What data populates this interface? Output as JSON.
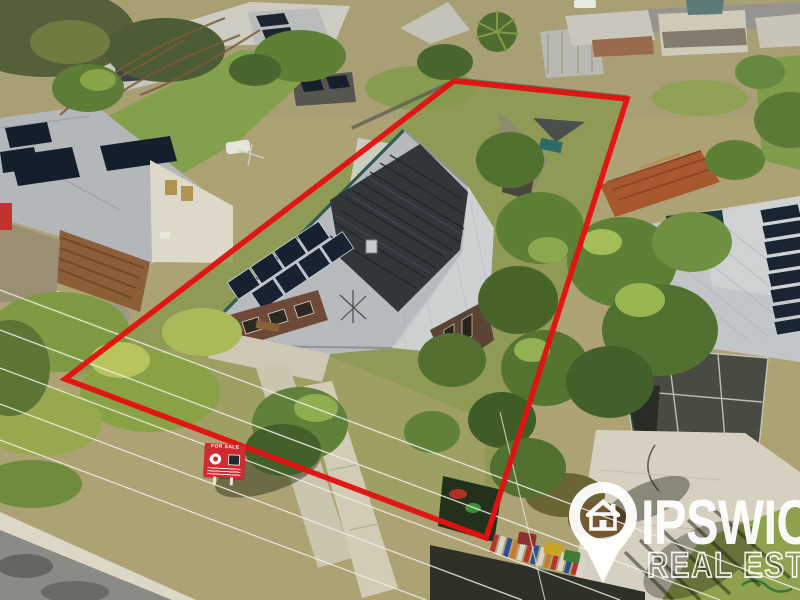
{
  "image_type": "aerial-drone-real-estate-photo",
  "watermark": {
    "brand_line1": "IPSWICH",
    "brand_line2": "REAL ESTATE",
    "icon": "location-pin-house-icon",
    "color": "#ffffff"
  },
  "boundary": {
    "points": "454,81 627,99 486,538 65,379",
    "color": "#e31212",
    "stroke_width": 5.5
  },
  "for_sale_sign": {
    "label": "FOR SALE",
    "color": "#cf2b33"
  },
  "colors": {
    "boundary_red": "#e31212",
    "sign_red": "#cf2b33",
    "watermark_white": "#ffffff"
  }
}
